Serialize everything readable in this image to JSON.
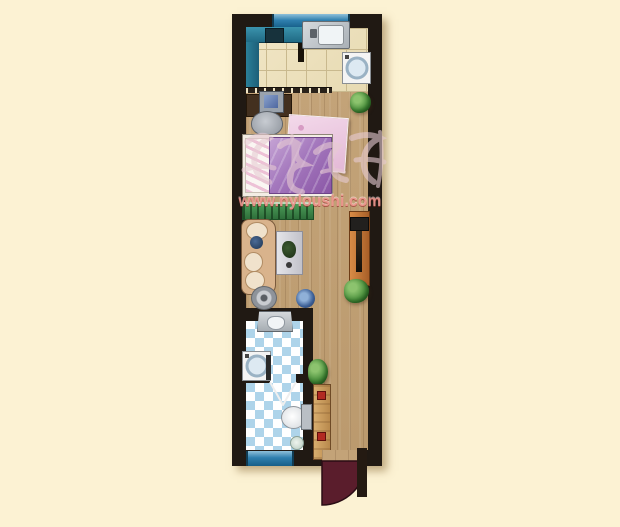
{
  "scene": {
    "kind": "residential-floor-plan",
    "canvas": {
      "width": 620,
      "height": 527
    },
    "description": "Narrow single-bay studio apartment plan: kitchen at top, bedroom and living area in middle on wood floor, bathroom with checkered tile and entry door at bottom"
  },
  "watermark": {
    "site_text": "www.nyloushi.com",
    "logo": "chinese-brush-calligraphy",
    "color": "#ee968e"
  },
  "palette": {
    "page_background": "#fcf2d3",
    "walls": "#201913",
    "kitchen_tile": "#eee3c2",
    "tile_grout": "#c9b98e",
    "wood_floor": "#c2a277",
    "window_blue": "#2f7fae",
    "cabinet_teal": "#2b7f99",
    "bed_purple": "#9c6cb4",
    "quilt_pink": "#ecc9e2",
    "cabinet_green": "#3f8a4a",
    "sofa_beige": "#d9b38c",
    "coffee_table_gray": "#d8d8dd",
    "tv_stand_orange": "#c87a3c",
    "bath_checker_blue": "#aed4ea",
    "door_arc_maroon": "#5a1d2c",
    "plant_green": "#3f8e3c"
  },
  "rooms": {
    "kitchen": {
      "floor": "cream ceramic tile",
      "items": [
        "teal-counter",
        "stove",
        "teal-side-cabinet",
        "steel-sink-counter",
        "washing-machine",
        "top-window",
        "sliding-door-track"
      ]
    },
    "bedroom": {
      "floor": "wood",
      "items": [
        "desk",
        "computer-monitor",
        "chair",
        "double-bed",
        "pink-quilt",
        "potted-plant",
        "green-low-cabinet"
      ]
    },
    "living": {
      "floor": "wood",
      "items": [
        "sofa",
        "navy-pillow",
        "coffee-table",
        "table-plant",
        "floor-fan",
        "blue-stool",
        "tv-cabinet",
        "tv",
        "potted-plant"
      ]
    },
    "bathroom": {
      "floor": "blue-white checker tile",
      "items": [
        "wash-basin",
        "washing-machine",
        "inner-door-swing",
        "toilet",
        "floor-drain",
        "bottom-window"
      ]
    },
    "entry": {
      "floor": "wood",
      "items": [
        "corner-plant",
        "shoe-bench",
        "entry-door-leaf",
        "maroon-door-swing-arc"
      ]
    }
  }
}
